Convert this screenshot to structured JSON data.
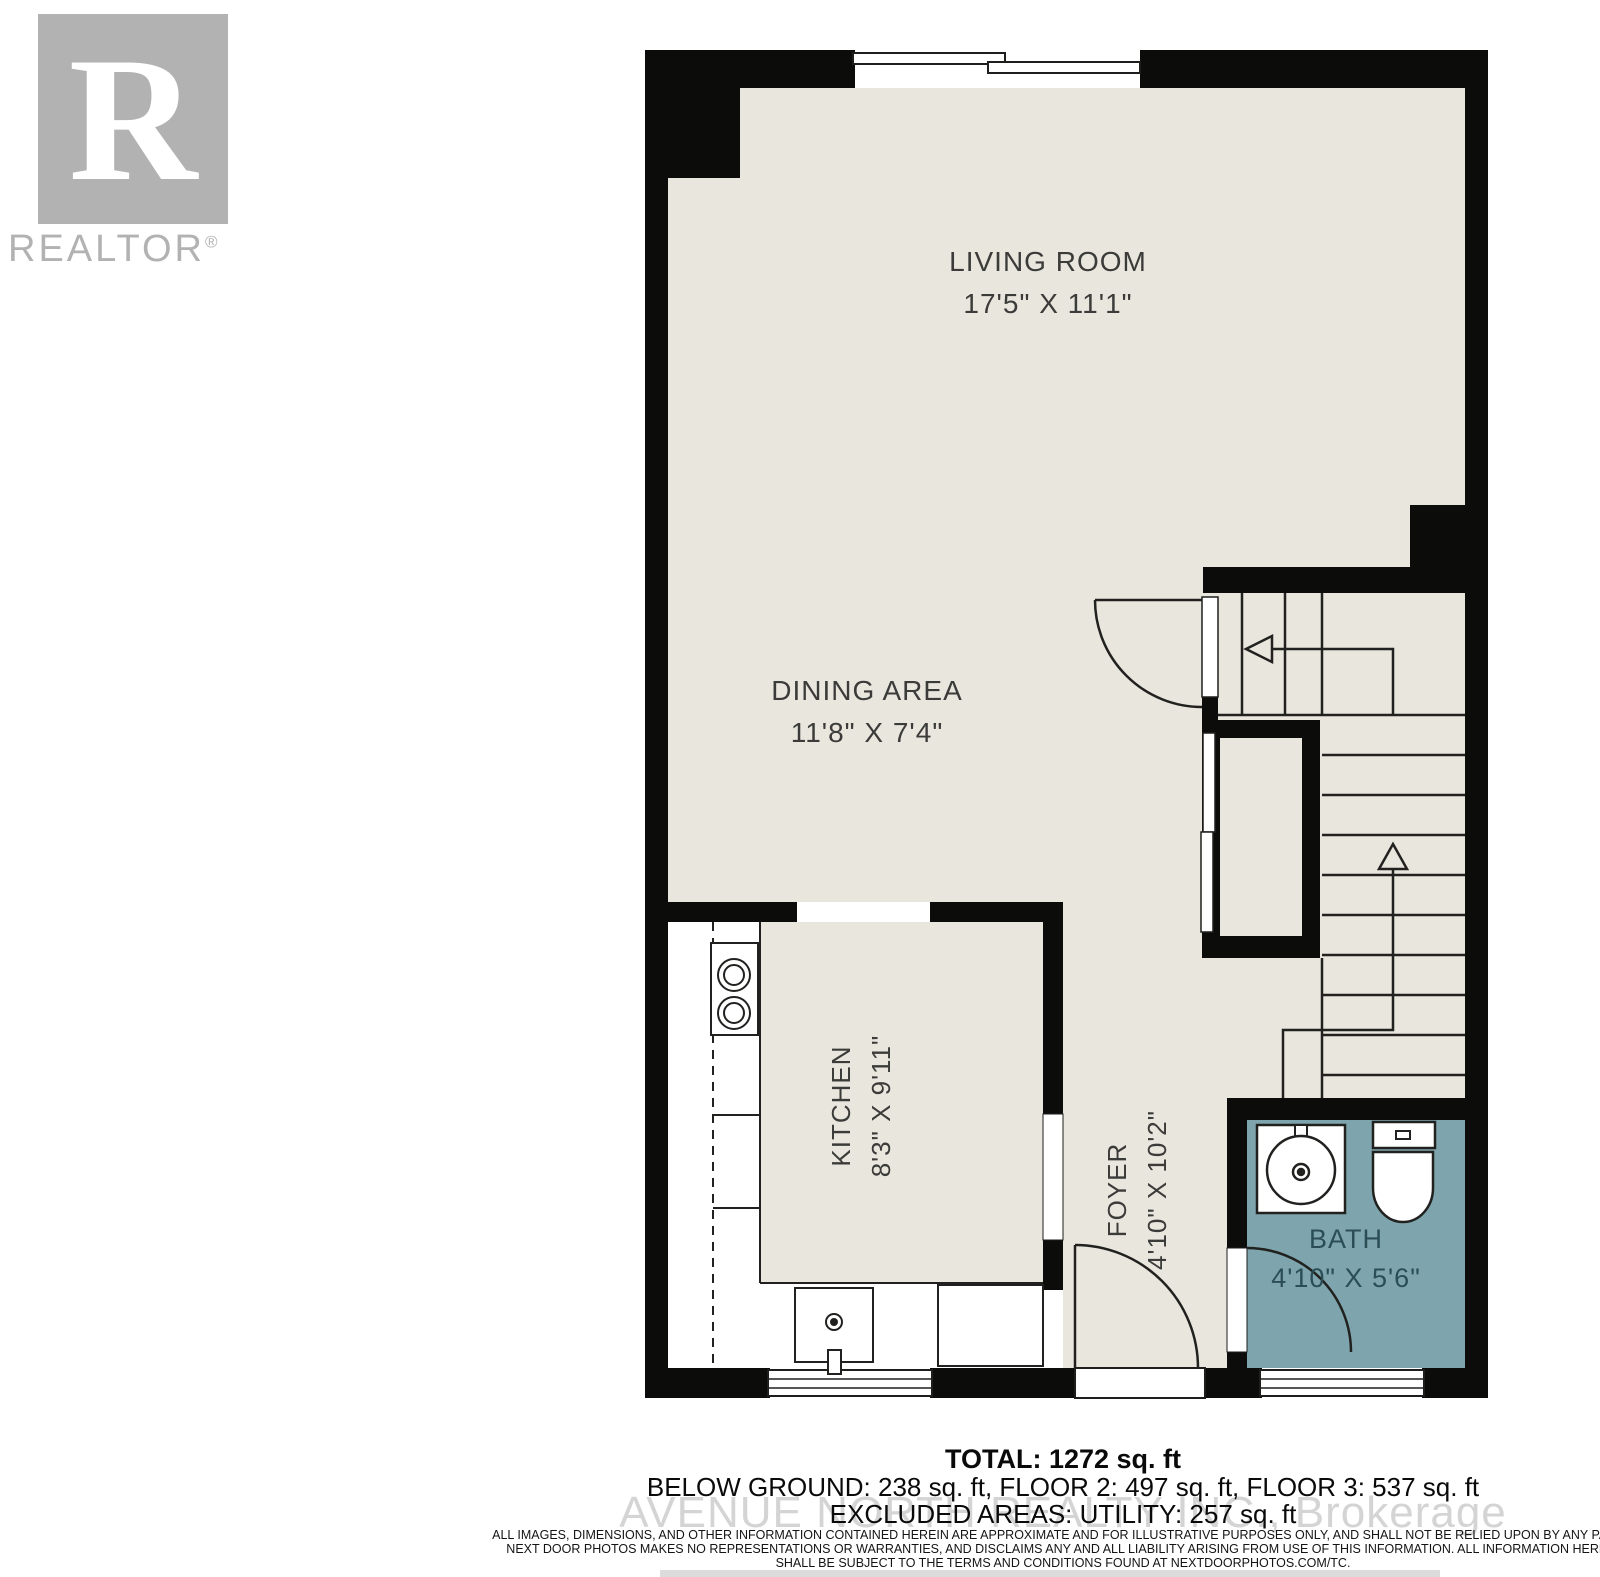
{
  "branding": {
    "logo_letter": "R",
    "logo_label": "REALTOR",
    "logo_reg": "®"
  },
  "rooms": {
    "living_room": {
      "name": "LIVING ROOM",
      "dims": "17'5\" X 11'1\""
    },
    "dining_area": {
      "name": "DINING AREA",
      "dims": "11'8\" X 7'4\""
    },
    "kitchen": {
      "name": "KITCHEN",
      "dims": "8'3\" X 9'11\""
    },
    "foyer": {
      "name": "FOYER",
      "dims": "4'10\" X 10'2\""
    },
    "bath": {
      "name": "BATH",
      "dims": "4'10\" X 5'6\""
    }
  },
  "footer": {
    "total": "TOTAL: 1272 sq. ft",
    "breakdown": "BELOW GROUND: 238 sq. ft, FLOOR 2: 497 sq. ft, FLOOR 3: 537 sq. ft",
    "excluded": "EXCLUDED AREAS: UTILITY: 257 sq. ft",
    "watermark": "AVENUE NORTH REALTY INC., Brokerage",
    "disclaimer": [
      "ALL IMAGES, DIMENSIONS, AND OTHER INFORMATION CONTAINED HEREIN ARE APPROXIMATE AND FOR ILLUSTRATIVE PURPOSES ONLY, AND SHALL NOT BE RELIED UPON BY ANY PARTY.",
      "NEXT DOOR PHOTOS MAKES NO REPRESENTATIONS OR WARRANTIES, AND DISCLAIMS ANY AND ALL LIABILITY ARISING FROM USE OF THIS INFORMATION. ALL INFORMATION HEREIN",
      "SHALL BE SUBJECT TO THE TERMS AND CONDITIONS FOUND AT NEXTDOORPHOTOS.COM/TC."
    ]
  },
  "colors": {
    "floor": "#e8e6dd",
    "bath_floor": "#7ea5ad",
    "walls": "#0c0c0b",
    "line": "#21211f",
    "label_text": "#3b3b39",
    "bath_label_text": "#2b4d56",
    "logo_gray": "#b2b2b2",
    "watermark_gray": "#d4d4d4"
  }
}
